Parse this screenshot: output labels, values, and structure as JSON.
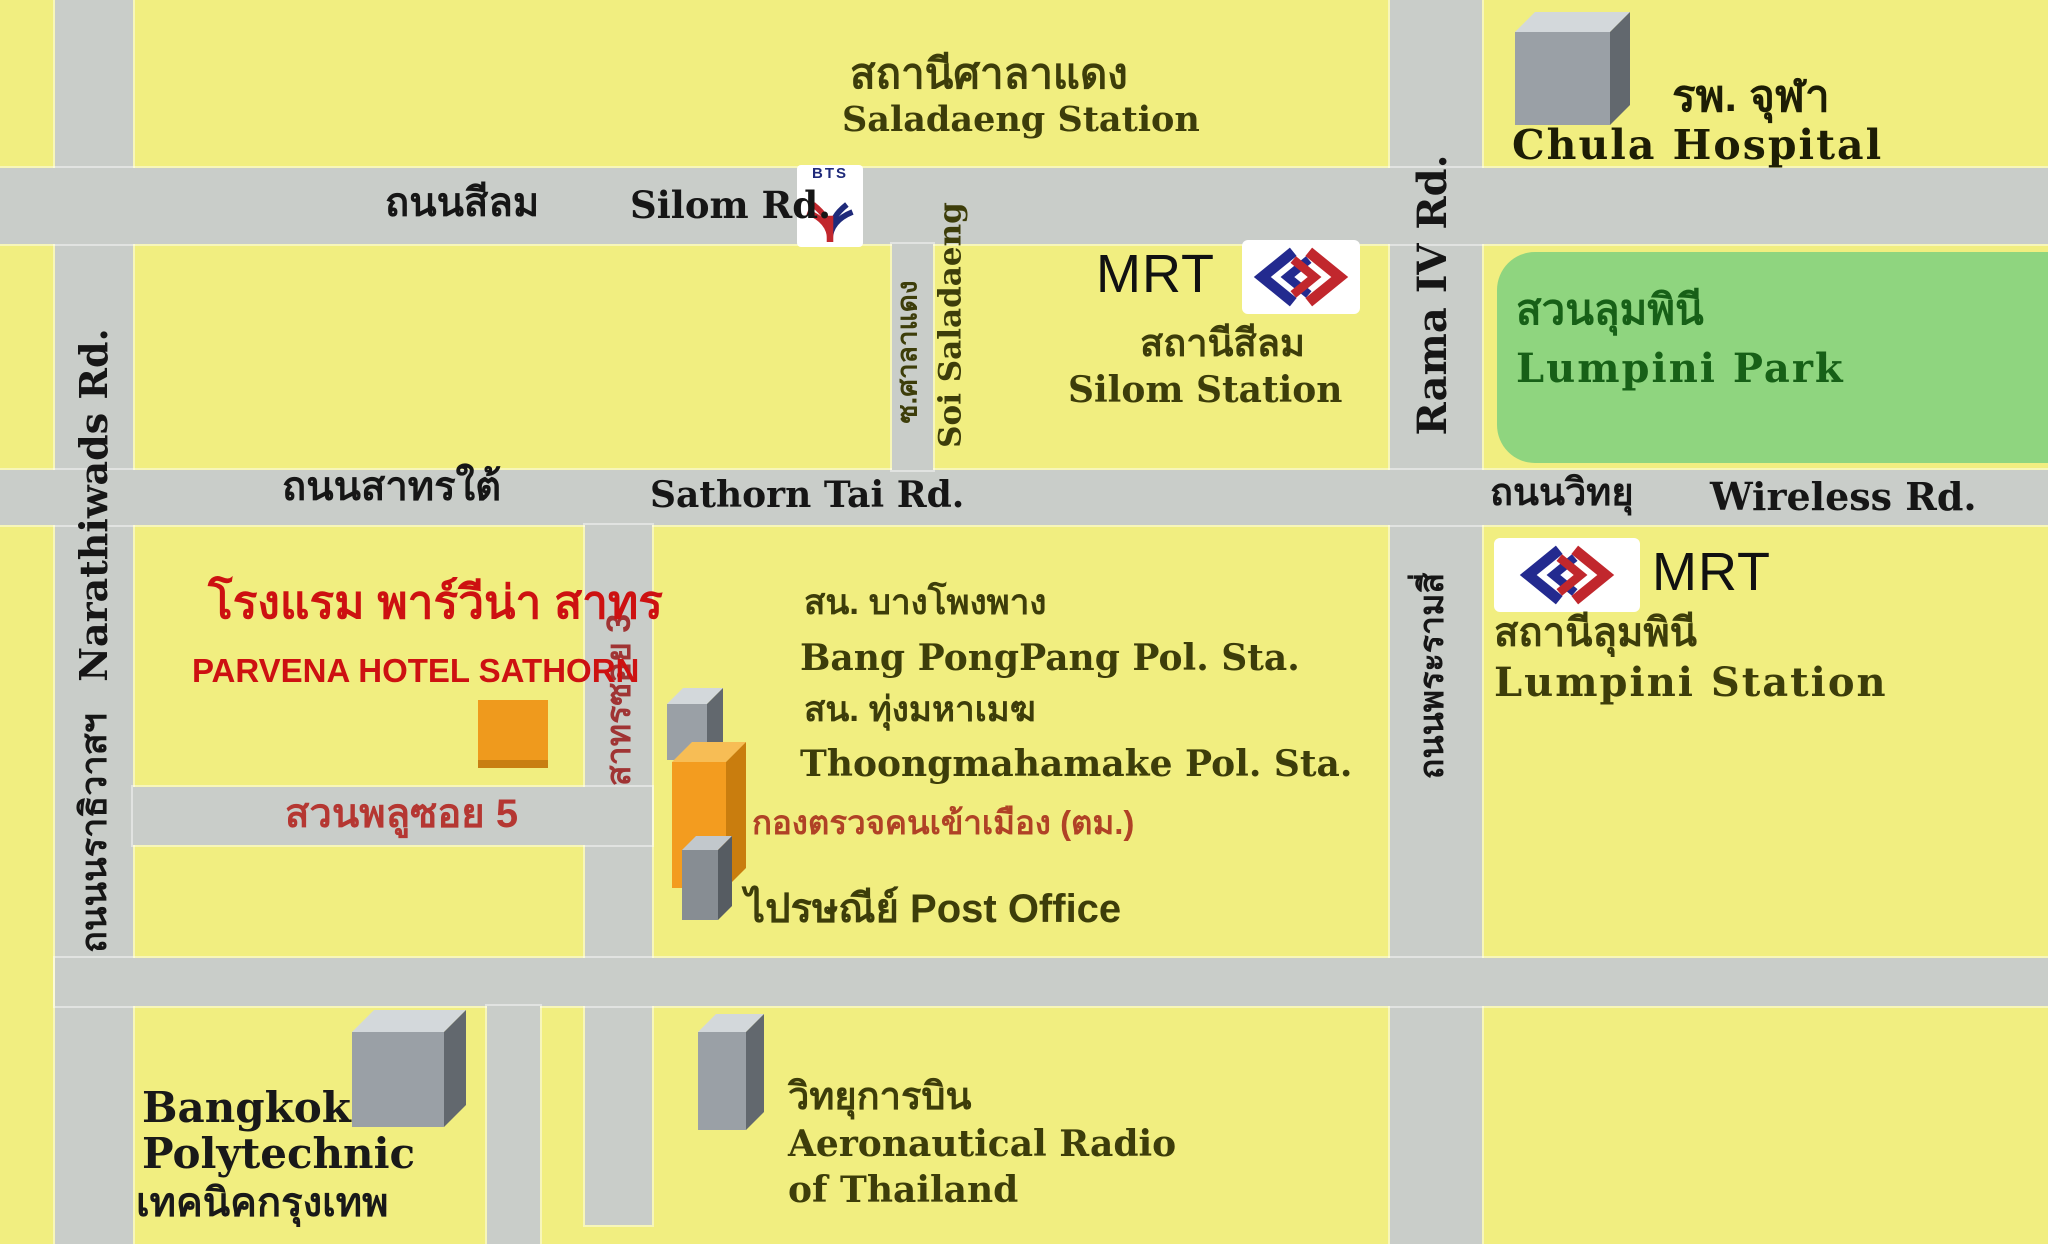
{
  "title": "Parvena Hotel Sathorn location map",
  "colors": {
    "block_yellow": "#f1ee80",
    "road_gray": "#c9cdc9",
    "park_green": "#8fd57f",
    "park_text_green": "#176017",
    "hotel_red": "#cd1111",
    "soi_red": "#b53732",
    "immigration_red": "#b04226",
    "place_olive": "#3d3d0a",
    "road_text_black": "#161616",
    "building_orange": "#f39c1f",
    "building_gray": "#9aa0a6",
    "mrt_navy": "#232a8f",
    "mrt_red": "#c1272d"
  },
  "roads": {
    "silom": {
      "thai": "ถนนสีลม",
      "en": "Silom Rd."
    },
    "sathorn": {
      "thai": "ถนนสาทรใต้",
      "en": "Sathorn Tai Rd."
    },
    "wireless": {
      "thai": "ถนนวิทยุ",
      "en": "Wireless Rd."
    },
    "narathiwat": {
      "thai": "ถนนนราธิวาสฯ",
      "en": "Narathiwads Rd."
    },
    "rama4": {
      "thai": "ถนนพระรามสี่",
      "en": "Rama IV Rd."
    },
    "soi_saladaeng": {
      "thai": "ซ.ศาลาแดง",
      "en": "Soi Saladaeng"
    },
    "sathorn_soi3": {
      "thai": "สาทรซอย 3"
    },
    "suan_phlu_soi5": {
      "thai": "สวนพลูซอย 5"
    }
  },
  "stations": {
    "saladaeng": {
      "thai": "สถานีศาลาแดง",
      "en": "Saladaeng Station"
    },
    "silom": {
      "mrt": "MRT",
      "thai": "สถานีสีลม",
      "en": "Silom Station"
    },
    "lumpini": {
      "mrt": "MRT",
      "thai": "สถานีลุมพินี",
      "en": "Lumpini Station"
    }
  },
  "logos": {
    "bts": {
      "text": "BTS"
    },
    "mrt": {
      "name": "MRT subway logo"
    }
  },
  "places": {
    "chula": {
      "thai": "รพ. จุฬา",
      "en": "Chula Hospital"
    },
    "lumpini_park": {
      "thai": "สวนลุมพินี",
      "en": "Lumpini Park"
    },
    "hotel": {
      "thai": "โรงแรม พาร์วีน่า สาทร",
      "en": "PARVENA HOTEL SATHORN"
    },
    "bangpongpang": {
      "thai": "สน. บางโพงพาง",
      "en": "Bang PongPang Pol. Sta."
    },
    "thoongmahamake": {
      "thai": "สน. ทุ่งมหาเมฆ",
      "en": "Thoongmahamake Pol. Sta."
    },
    "immigration": {
      "thai": "กองตรวจคนเข้าเมือง (ตม.)"
    },
    "post_office": {
      "label": "ไปรษณีย์ Post Office"
    },
    "polytechnic": {
      "en_line1": "Bangkok",
      "en_line2": "Polytechnic",
      "thai": "เทคนิคกรุงเทพ"
    },
    "aerothai": {
      "thai": "วิทยุการบิน",
      "en_line1": "Aeronautical Radio",
      "en_line2": "of Thailand"
    }
  }
}
